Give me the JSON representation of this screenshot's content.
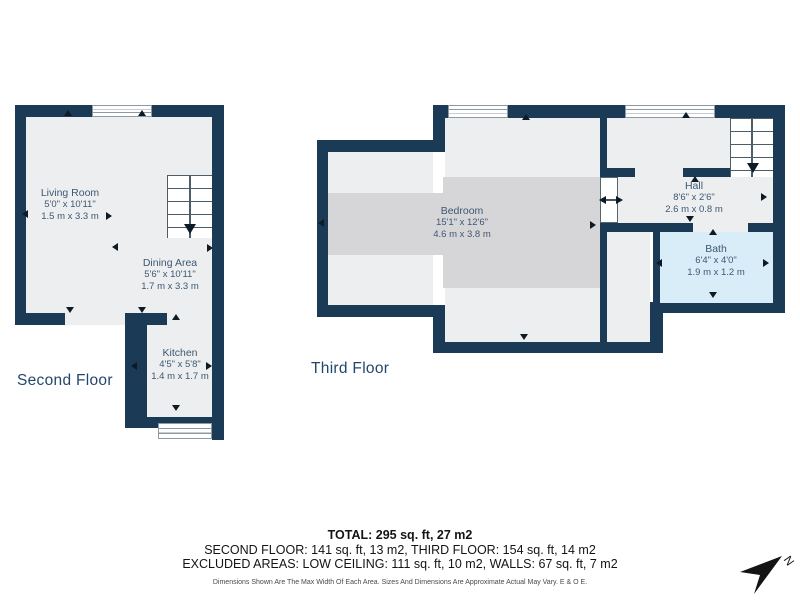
{
  "colors": {
    "wall": "#1b3a55",
    "floor": "#edeeef",
    "low_ceiling": "#d6d6d8",
    "bath": "#d9edf9",
    "label_text": "#3d5874"
  },
  "floors": {
    "second": {
      "name": "Second Floor",
      "rooms": [
        {
          "name": "Living Room",
          "imperial": "5'0\" x 10'11\"",
          "metric": "1.5 m x 3.3 m"
        },
        {
          "name": "Dining Area",
          "imperial": "5'6\" x 10'11\"",
          "metric": "1.7 m x 3.3 m"
        },
        {
          "name": "Kitchen",
          "imperial": "4'5\" x 5'8\"",
          "metric": "1.4 m x 1.7 m"
        }
      ]
    },
    "third": {
      "name": "Third Floor",
      "rooms": [
        {
          "name": "Bedroom",
          "imperial": "15'1\" x 12'6\"",
          "metric": "4.6 m x 3.8 m"
        },
        {
          "name": "Hall",
          "imperial": "8'6\" x 2'6\"",
          "metric": "2.6 m x 0.8 m"
        },
        {
          "name": "Bath",
          "imperial": "6'4\" x 4'0\"",
          "metric": "1.9 m x 1.2 m"
        }
      ]
    }
  },
  "summary": {
    "total": "TOTAL: 295 sq. ft, 27 m2",
    "by_floor": "SECOND FLOOR: 141 sq. ft, 13 m2, THIRD FLOOR: 154 sq. ft, 14 m2",
    "excluded": "EXCLUDED AREAS: LOW CEILING: 111 sq. ft, 10 m2, WALLS: 67 sq. ft, 7 m2",
    "disclaimer": "Dimensions Shown Are The Max Width Of Each Area. Sizes And Dimensions Are Approximate Actual May Vary. E & O E."
  },
  "compass": {
    "label": "N"
  }
}
